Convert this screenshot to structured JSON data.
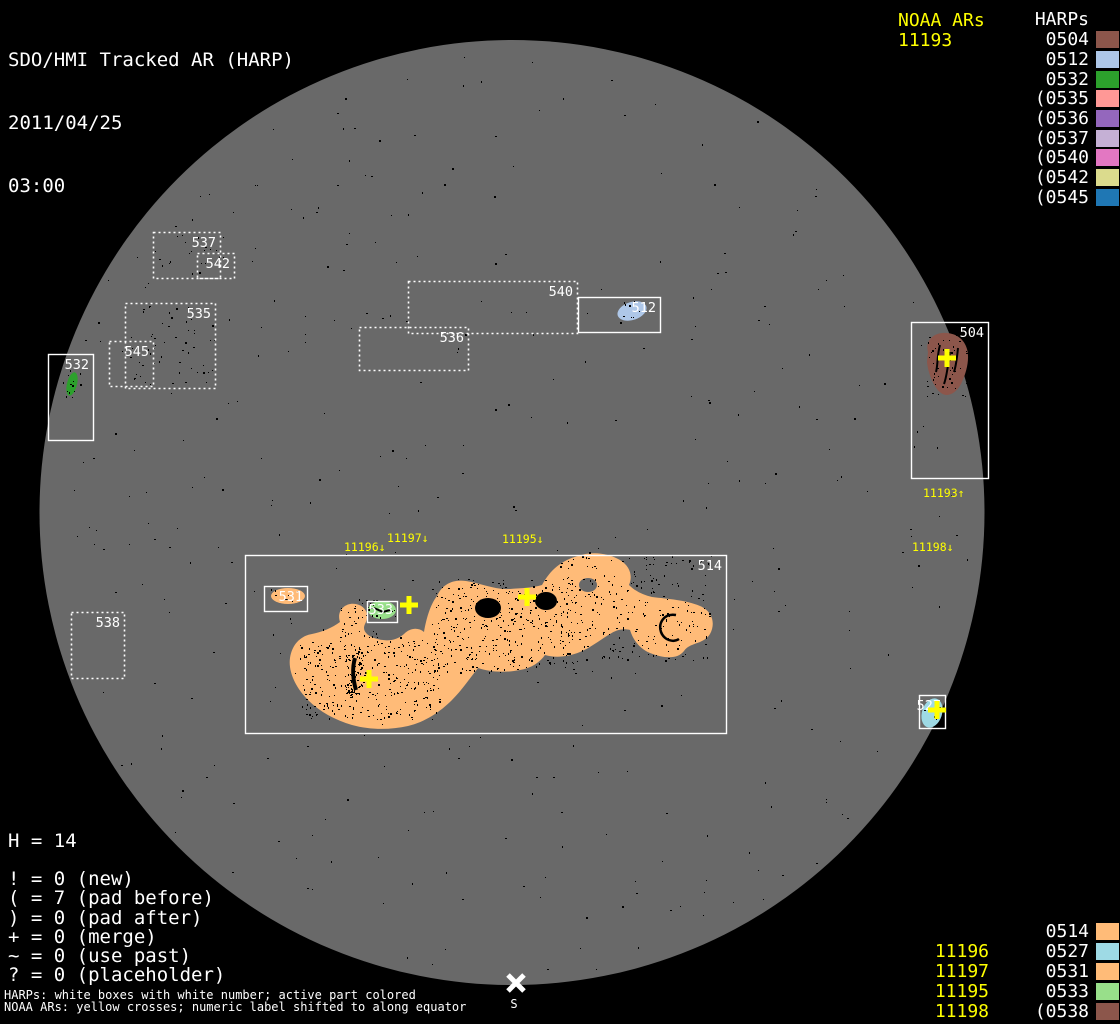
{
  "header": {
    "title": "SDO/HMI Tracked AR (HARP)",
    "date": "2011/04/25",
    "time": "03:00"
  },
  "top_right": {
    "noaa_header": "NOAA ARs",
    "noaa_items": [
      "11193"
    ],
    "harps_header": "HARPs",
    "harps": [
      {
        "label": "0504",
        "color": "#8C564B"
      },
      {
        "label": "0512",
        "color": "#AEC7E8"
      },
      {
        "label": "0532",
        "color": "#2CA02C"
      },
      {
        "label": "(0535",
        "color": "#FF9896"
      },
      {
        "label": "(0536",
        "color": "#9467BD"
      },
      {
        "label": "(0537",
        "color": "#C5B0D5"
      },
      {
        "label": "(0540",
        "color": "#E377C2"
      },
      {
        "label": "(0542",
        "color": "#DBDB8D"
      },
      {
        "label": "(0545",
        "color": "#1F77B4"
      }
    ]
  },
  "bottom_right": {
    "rows": [
      {
        "noaa": "",
        "harp": "0514",
        "color": "#FFBB78"
      },
      {
        "noaa": "11196",
        "harp": "0527",
        "color": "#9EDAE5"
      },
      {
        "noaa": "11197",
        "harp": "0531",
        "color": "#FFBB78"
      },
      {
        "noaa": "11195",
        "harp": "0533",
        "color": "#98DF8A"
      },
      {
        "noaa": "11198",
        "harp": "(0538",
        "color": "#8C564B"
      }
    ]
  },
  "stats": {
    "h_count": "H = 14",
    "lines": [
      "! = 0 (new)",
      "( = 7 (pad before)",
      ") = 0 (pad after)",
      "+ = 0 (merge)",
      "~ = 0 (use past)",
      "? = 0 (placeholder)"
    ]
  },
  "footnotes": [
    "HARPs: white boxes with white number; active part colored",
    "NOAA ARs: yellow crosses; numeric label shifted to along equator"
  ],
  "disk": {
    "background_color": "#696969",
    "boxes": [
      {
        "label": "537",
        "x": 153,
        "y": 232,
        "w": 67,
        "h": 46,
        "style": "dotted"
      },
      {
        "label": "542",
        "x": 197,
        "y": 253,
        "w": 37,
        "h": 25,
        "style": "dotted"
      },
      {
        "label": "535",
        "x": 125,
        "y": 303,
        "w": 90,
        "h": 85,
        "style": "dotted"
      },
      {
        "label": "545",
        "x": 109,
        "y": 341,
        "w": 44,
        "h": 45,
        "style": "dotted"
      },
      {
        "label": "540",
        "x": 408,
        "y": 281,
        "w": 169,
        "h": 52,
        "style": "dotted"
      },
      {
        "label": "536",
        "x": 359,
        "y": 327,
        "w": 109,
        "h": 43,
        "style": "dotted"
      },
      {
        "label": "538",
        "x": 71,
        "y": 612,
        "w": 53,
        "h": 66,
        "style": "dotted"
      },
      {
        "label": "532",
        "x": 48,
        "y": 354,
        "w": 45,
        "h": 86,
        "style": "solid"
      },
      {
        "label": "512",
        "x": 578,
        "y": 297,
        "w": 82,
        "h": 35,
        "style": "solid"
      },
      {
        "label": "504",
        "x": 911,
        "y": 322,
        "w": 77,
        "h": 156,
        "style": "solid"
      },
      {
        "label": "514",
        "x": 245,
        "y": 555,
        "w": 481,
        "h": 178,
        "style": "solid"
      },
      {
        "label": "531",
        "x": 264,
        "y": 586,
        "w": 43,
        "h": 25,
        "style": "solid"
      },
      {
        "label": "533",
        "x": 367,
        "y": 601,
        "w": 30,
        "h": 21,
        "style": "solid"
      },
      {
        "label": "527",
        "x": 919,
        "y": 695,
        "w": 26,
        "h": 33,
        "style": "solid"
      }
    ],
    "crosses": [
      {
        "x": 409,
        "y": 605
      },
      {
        "x": 527,
        "y": 597
      },
      {
        "x": 369,
        "y": 679
      },
      {
        "x": 947,
        "y": 358
      },
      {
        "x": 937,
        "y": 710
      }
    ],
    "noaa_labels": [
      {
        "text": "11196↓",
        "x": 344,
        "y": 551
      },
      {
        "text": "11197↓",
        "x": 387,
        "y": 542
      },
      {
        "text": "11195↓",
        "x": 502,
        "y": 543
      },
      {
        "text": "11193↑",
        "x": 923,
        "y": 497
      },
      {
        "text": "11198↓",
        "x": 912,
        "y": 551
      }
    ],
    "south_marker": {
      "label": "S",
      "x": 516,
      "y": 983
    }
  },
  "blobs": [
    {
      "name": "harp-514-active",
      "color": "#FFBB78"
    },
    {
      "name": "harp-531-active",
      "color": "#FFBB78"
    },
    {
      "name": "harp-533-active",
      "color": "#98DF8A"
    },
    {
      "name": "harp-512-active",
      "color": "#AEC7E8"
    },
    {
      "name": "harp-532-active",
      "color": "#2CA02C"
    },
    {
      "name": "harp-504-active",
      "color": "#8C564B"
    },
    {
      "name": "harp-527-active",
      "color": "#9EDAE5"
    }
  ],
  "accent_colors": {
    "noaa_yellow": "#FFFF00",
    "harp_white": "#FFFFFF"
  }
}
